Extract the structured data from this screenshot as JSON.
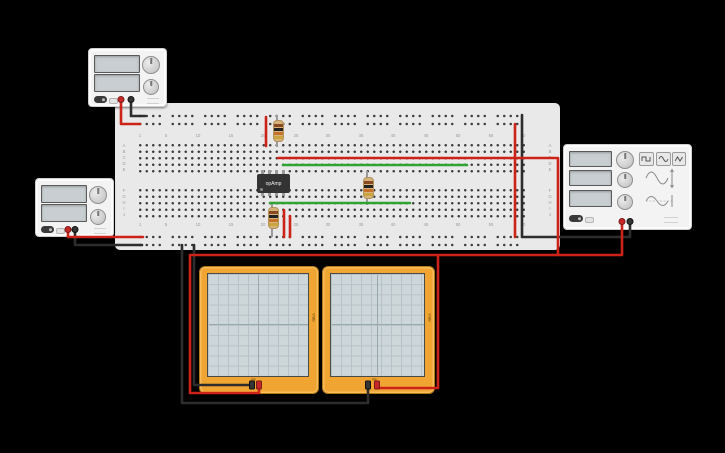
{
  "colors": {
    "background": "#000000",
    "breadboard": "#e9e9e9",
    "wire_red": "#cc2218",
    "wire_black": "#2d2d2d",
    "wire_green": "#31a335",
    "scope_frame": "#f0a432",
    "scope_screen": "#cdd6d8",
    "device_body": "#f3f3f3",
    "display_blank": "#c8ced1",
    "chip_body": "#333333",
    "resistor_body": "#d7b37c"
  },
  "breadboard": {
    "row_letters": [
      "A",
      "B",
      "C",
      "D",
      "E",
      "F",
      "G",
      "H",
      "I",
      "J"
    ],
    "column_numbers": [
      "1",
      "5",
      "10",
      "15",
      "20",
      "25",
      "30",
      "35",
      "40",
      "45",
      "50",
      "55",
      "60"
    ]
  },
  "opamp": {
    "label": "opAmp"
  },
  "oscilloscopes": {
    "left": {
      "side_label": "V/div",
      "bottom_label": "ms"
    },
    "right": {
      "side_label": "V/div",
      "bottom_label": "ms"
    }
  },
  "function_generator": {
    "wave_buttons": [
      {
        "icon": "square-wave-icon"
      },
      {
        "icon": "sine-wave-icon"
      },
      {
        "icon": "triangle-wave-icon"
      }
    ]
  }
}
